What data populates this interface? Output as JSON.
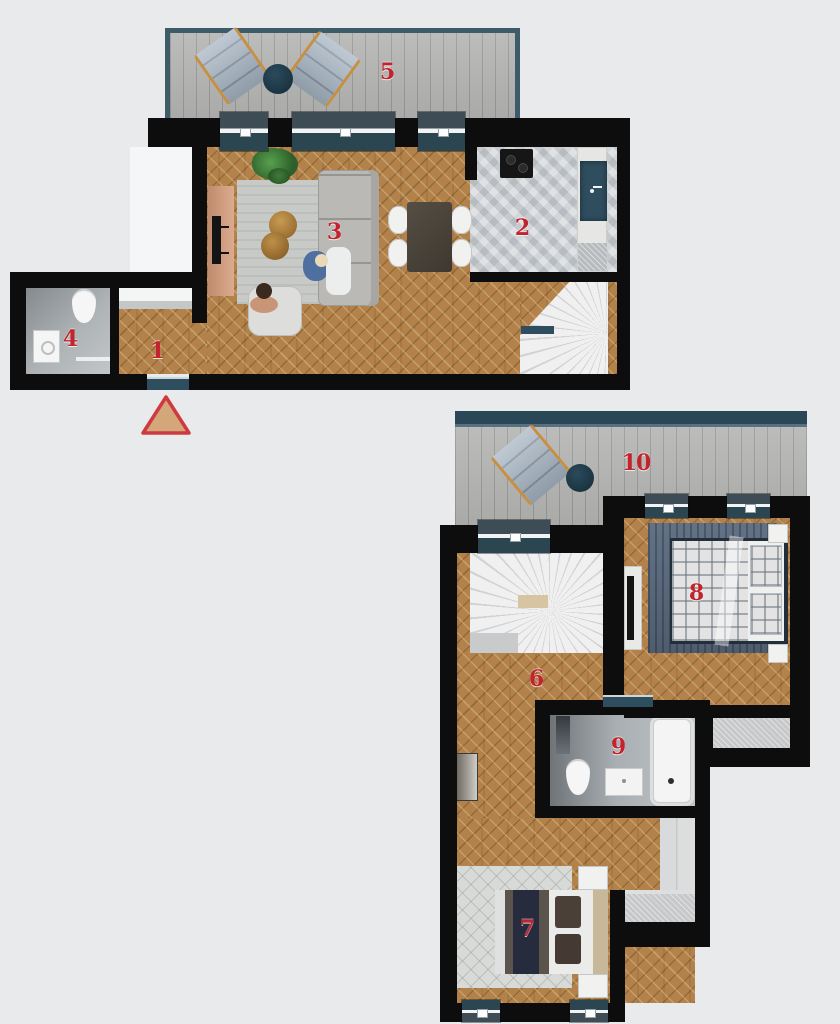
{
  "title": "two-storey apartment floor plan",
  "rooms": [
    {
      "number": "1"
    },
    {
      "number": "2"
    },
    {
      "number": "3"
    },
    {
      "number": "4"
    },
    {
      "number": "5"
    },
    {
      "number": "6"
    },
    {
      "number": "7"
    },
    {
      "number": "8"
    },
    {
      "number": "9"
    },
    {
      "number": "10"
    }
  ],
  "entrance_marker": {
    "symbol": "triangle"
  },
  "colors": {
    "background": "#e9eaec",
    "walls": "#0d0d0e",
    "room_number_red": "#c2242e",
    "window_teal": "#2e4d5e",
    "wood_floor": "#b2824a",
    "terrace_deck": "#b4b5b2",
    "entrance_triangle_fill": "#d4a77a",
    "entrance_triangle_border": "#cf3a41"
  }
}
